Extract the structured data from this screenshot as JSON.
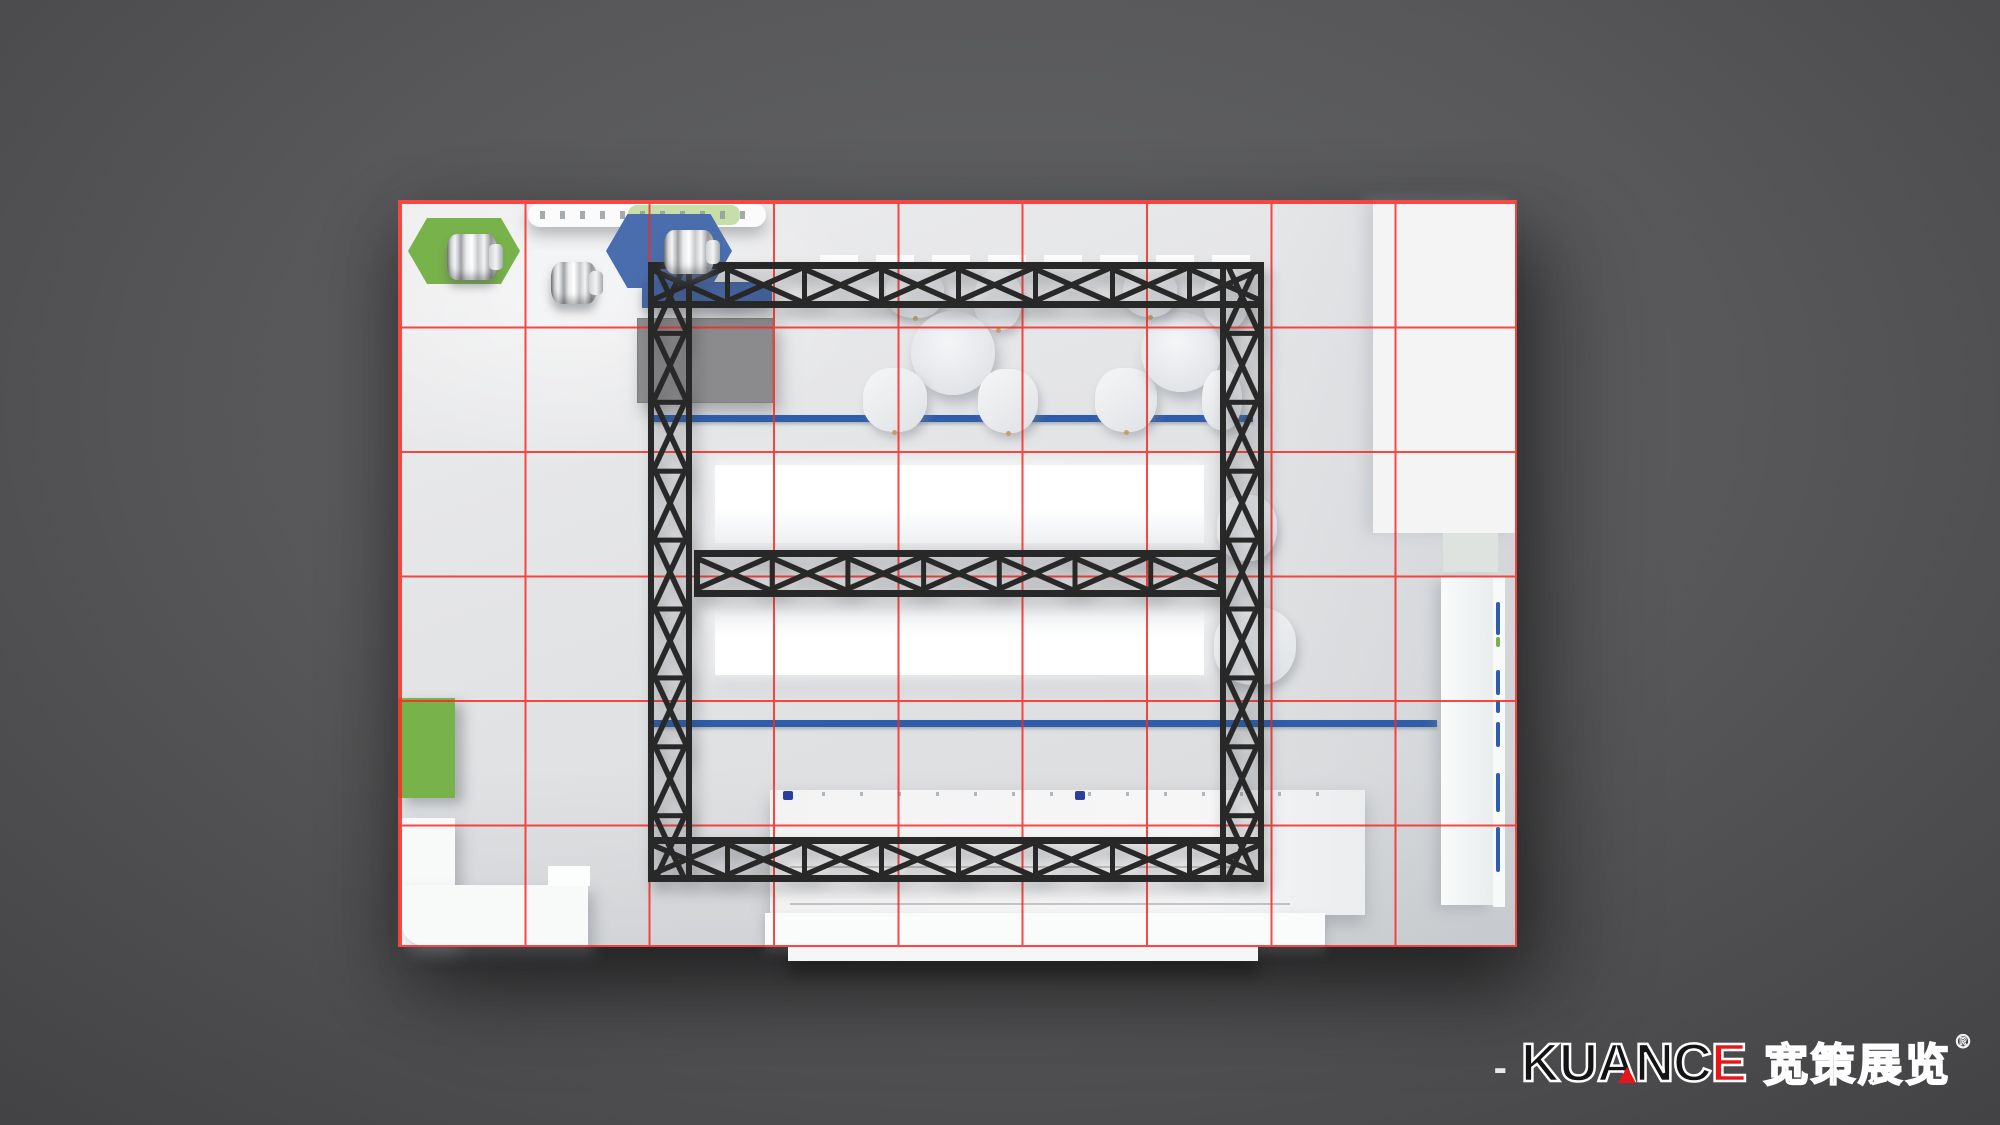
{
  "branding": {
    "dash": "-",
    "name_main": "KUANC",
    "name_accent": "E",
    "name_full": "KUANCE",
    "cn_name": "宽策展览",
    "reg": "®"
  },
  "colors": {
    "grid": "#fa2a24",
    "truss": "#282828",
    "green": "#78b24a",
    "hexblue": "#4a6dad",
    "deskblue": "#4668a8",
    "lineblue": "#2e5dab",
    "roomgray": "#8b8b8d",
    "floor": "#e0e1e3",
    "tan": "#c79a63",
    "logored": "#e8151a",
    "logoblack": "#141414"
  },
  "plan": {
    "grid_cols": 9,
    "grid_rows": 6,
    "description": "top view exhibition booth layout render",
    "fixtures": {
      "hex_platforms": 3,
      "product_cylinders": 3,
      "round_tables": 2,
      "chairs": 12,
      "truss_beams": 3,
      "truss_columns": 2,
      "blue_floor_lines": 2
    }
  }
}
